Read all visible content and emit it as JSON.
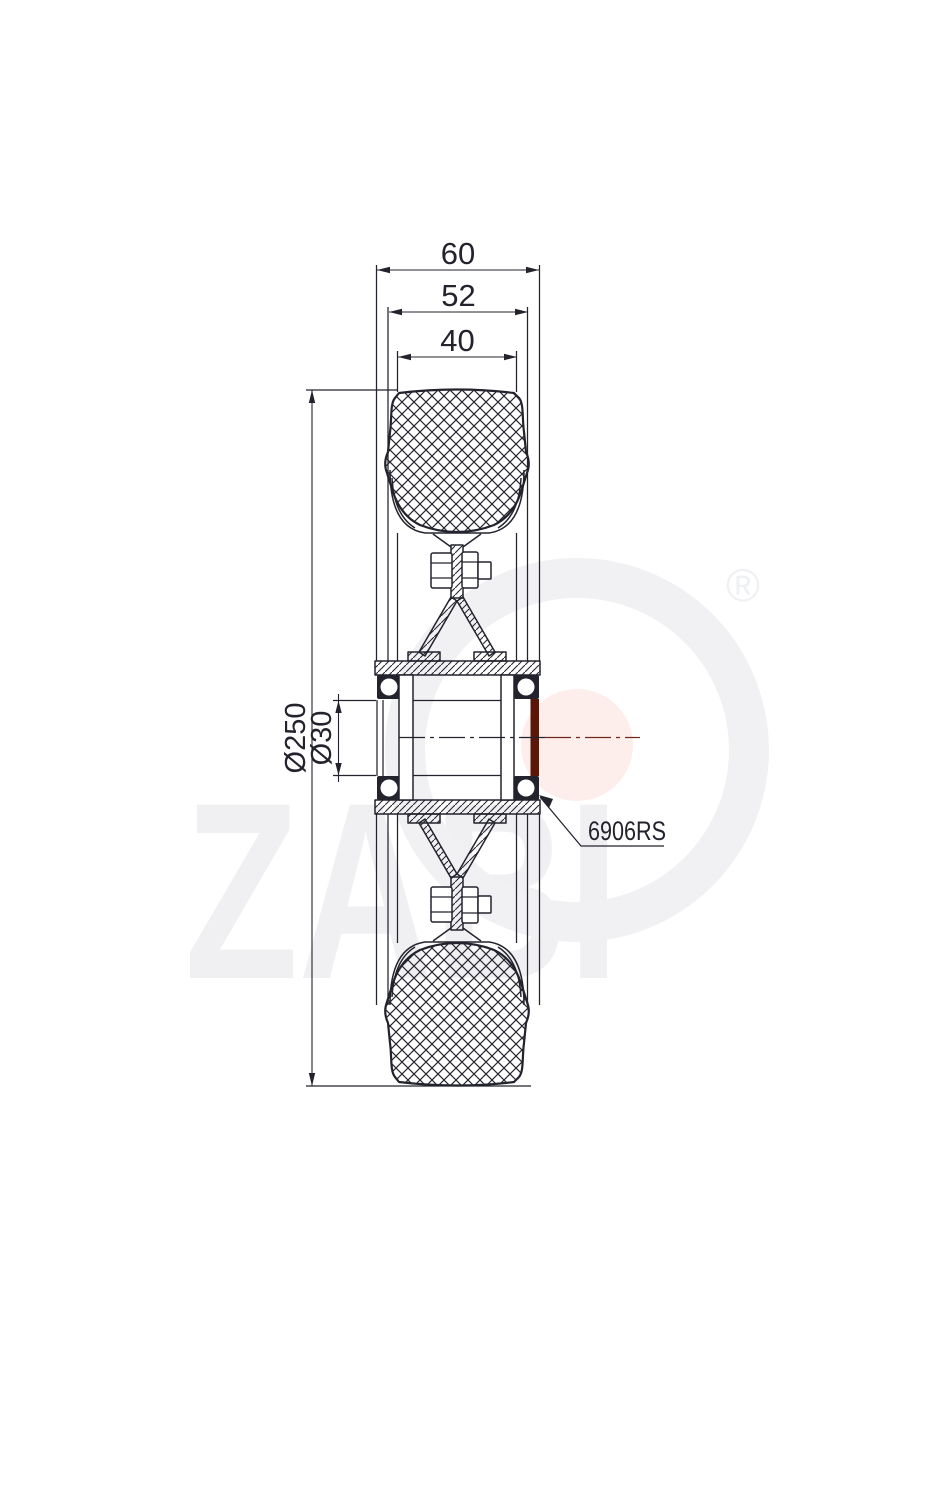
{
  "drawing": {
    "dim_hub_width": "60",
    "dim_rim_width": "52",
    "dim_tread_width": "40",
    "dim_outer_diameter": "Ø250",
    "dim_bore_diameter": "Ø30",
    "bearing_label": "6906RS"
  },
  "watermark": {
    "brand": "ZABI",
    "registered_symbol": "®"
  },
  "colors": {
    "line": "#23232e",
    "bearing_highlight": "#5a1708",
    "watermark_gray": "#f0f0f3",
    "watermark_pink": "#fdeeec"
  }
}
